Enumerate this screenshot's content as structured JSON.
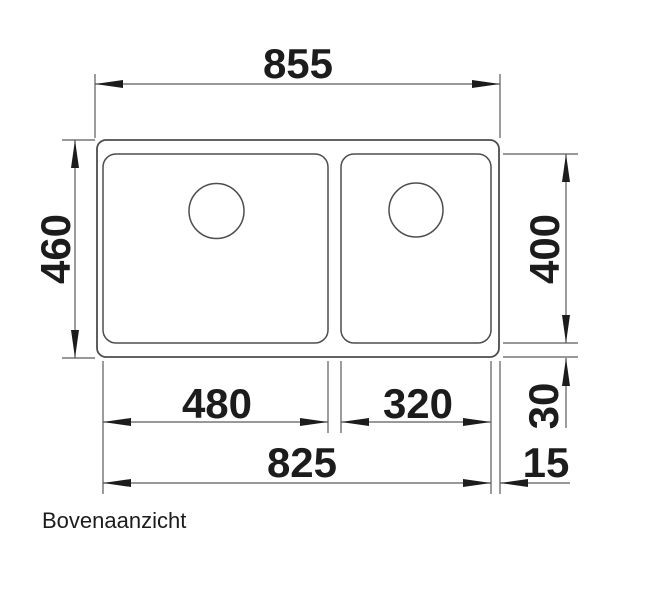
{
  "drawing": {
    "caption": "Bovenaanzicht",
    "dimensions": {
      "overall_width": "855",
      "overall_depth": "460",
      "bowl_depth": "400",
      "left_bowl_width": "480",
      "right_bowl_width": "320",
      "bottom_offset": "30",
      "inner_width": "825",
      "right_offset": "15"
    },
    "colors": {
      "outline": "#4d4d4d",
      "dimension": "#5a5a5a",
      "label": "#1c1c1c"
    }
  }
}
